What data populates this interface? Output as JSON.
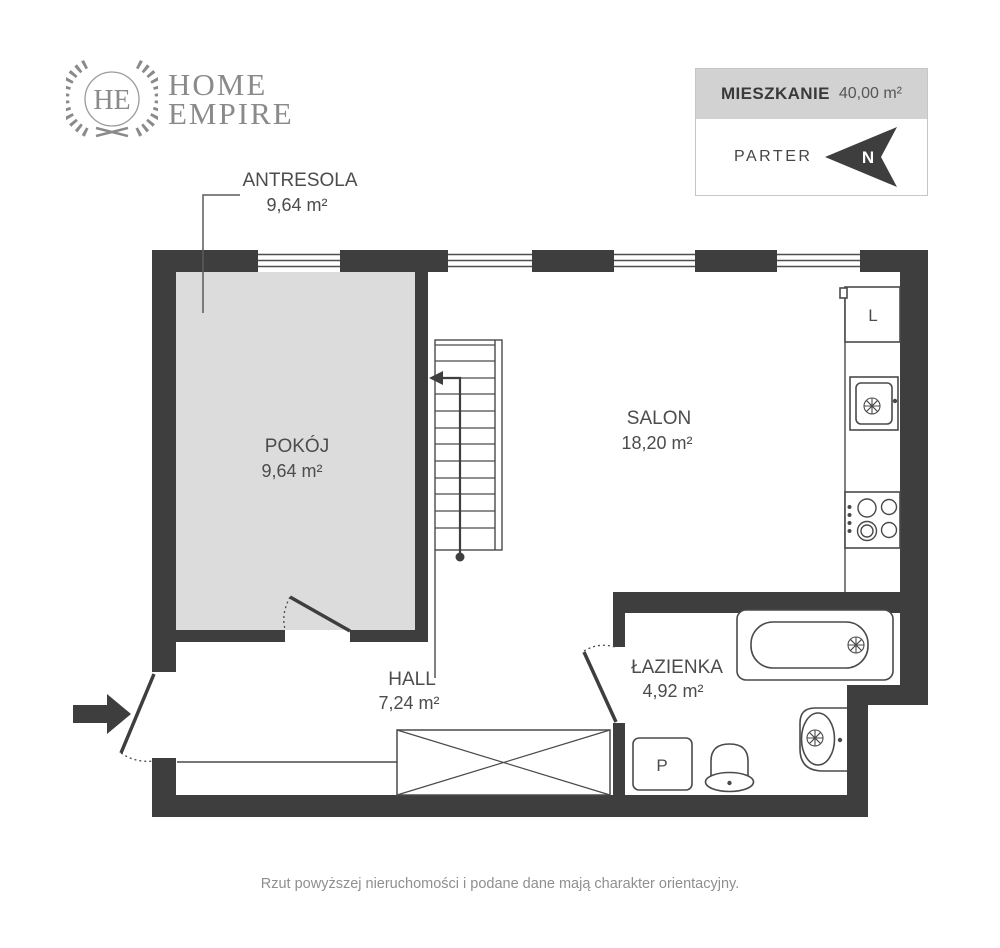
{
  "logo": {
    "monogram": "HE",
    "line1": "HOME",
    "line2": "EMPIRE"
  },
  "info_box": {
    "title": "MIESZKANIE",
    "area": "40,00 m²",
    "floor": "PARTER",
    "compass": "N"
  },
  "rooms": [
    {
      "id": "antresola",
      "name": "ANTRESOLA",
      "area": "9,64 m²"
    },
    {
      "id": "pokoj",
      "name": "POKÓJ",
      "area": "9,64 m²"
    },
    {
      "id": "salon",
      "name": "SALON",
      "area": "18,20 m²"
    },
    {
      "id": "hall",
      "name": "HALL",
      "area": "7,24 m²"
    },
    {
      "id": "lazienka",
      "name": "ŁAZIENKA",
      "area": "4,92 m²"
    }
  ],
  "fixtures": {
    "fridge_label": "L",
    "washer_label": "P"
  },
  "disclaimer": "Rzut powyższej nieruchomości i podane dane mają charakter orientacyjny.",
  "colors": {
    "wall": "#3e3e3e",
    "room_fill": "#dcdcdc",
    "line": "#4a4a4a",
    "text": "#4c4c4c",
    "logo": "#8a8a8a",
    "header_bg": "#d2d2d2",
    "border": "#c6c6c6",
    "disclaimer": "#8f8f8f"
  }
}
